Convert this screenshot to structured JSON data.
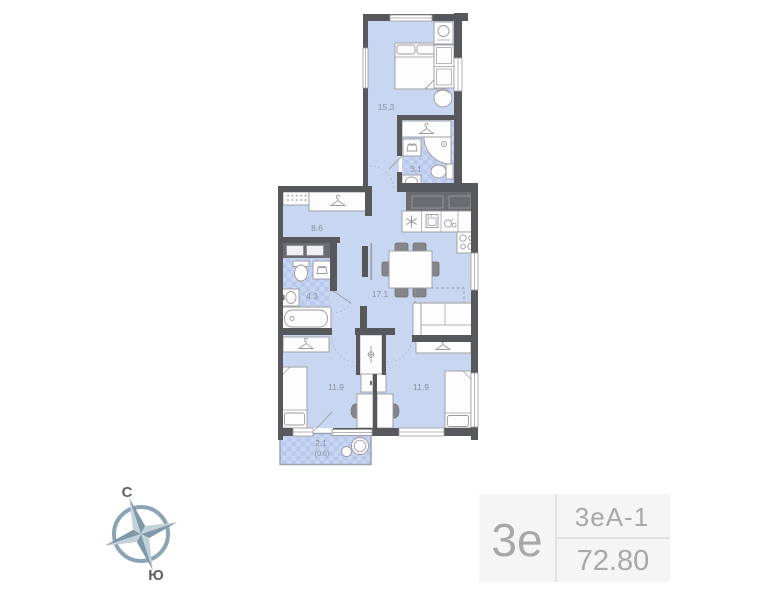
{
  "plan": {
    "rooms": {
      "bedroom_top": "15.3",
      "bathroom_small": "3.1",
      "hallway": "8.6",
      "bathroom_main": "4.3",
      "living_kitchen": "17.1",
      "bedroom_left": "11.9",
      "bedroom_right": "11.9",
      "balcony": "2.1",
      "balcony_reduced": "(0.6)"
    },
    "colors": {
      "wall": "#57585c",
      "floor": "#c9d6f1",
      "floor_checker": "#b9c8ec",
      "furniture_stroke": "#9b9ba0",
      "dark_furniture": "#6b6c70",
      "label_text": "#8b919c"
    }
  },
  "compass": {
    "north": "С",
    "south": "Ю"
  },
  "info_plate": {
    "rooms_short": "3е",
    "layout_code": "3еА-1",
    "total_area": "72.80",
    "bg": "#f5f5f6",
    "text": "#a8a8a8"
  }
}
